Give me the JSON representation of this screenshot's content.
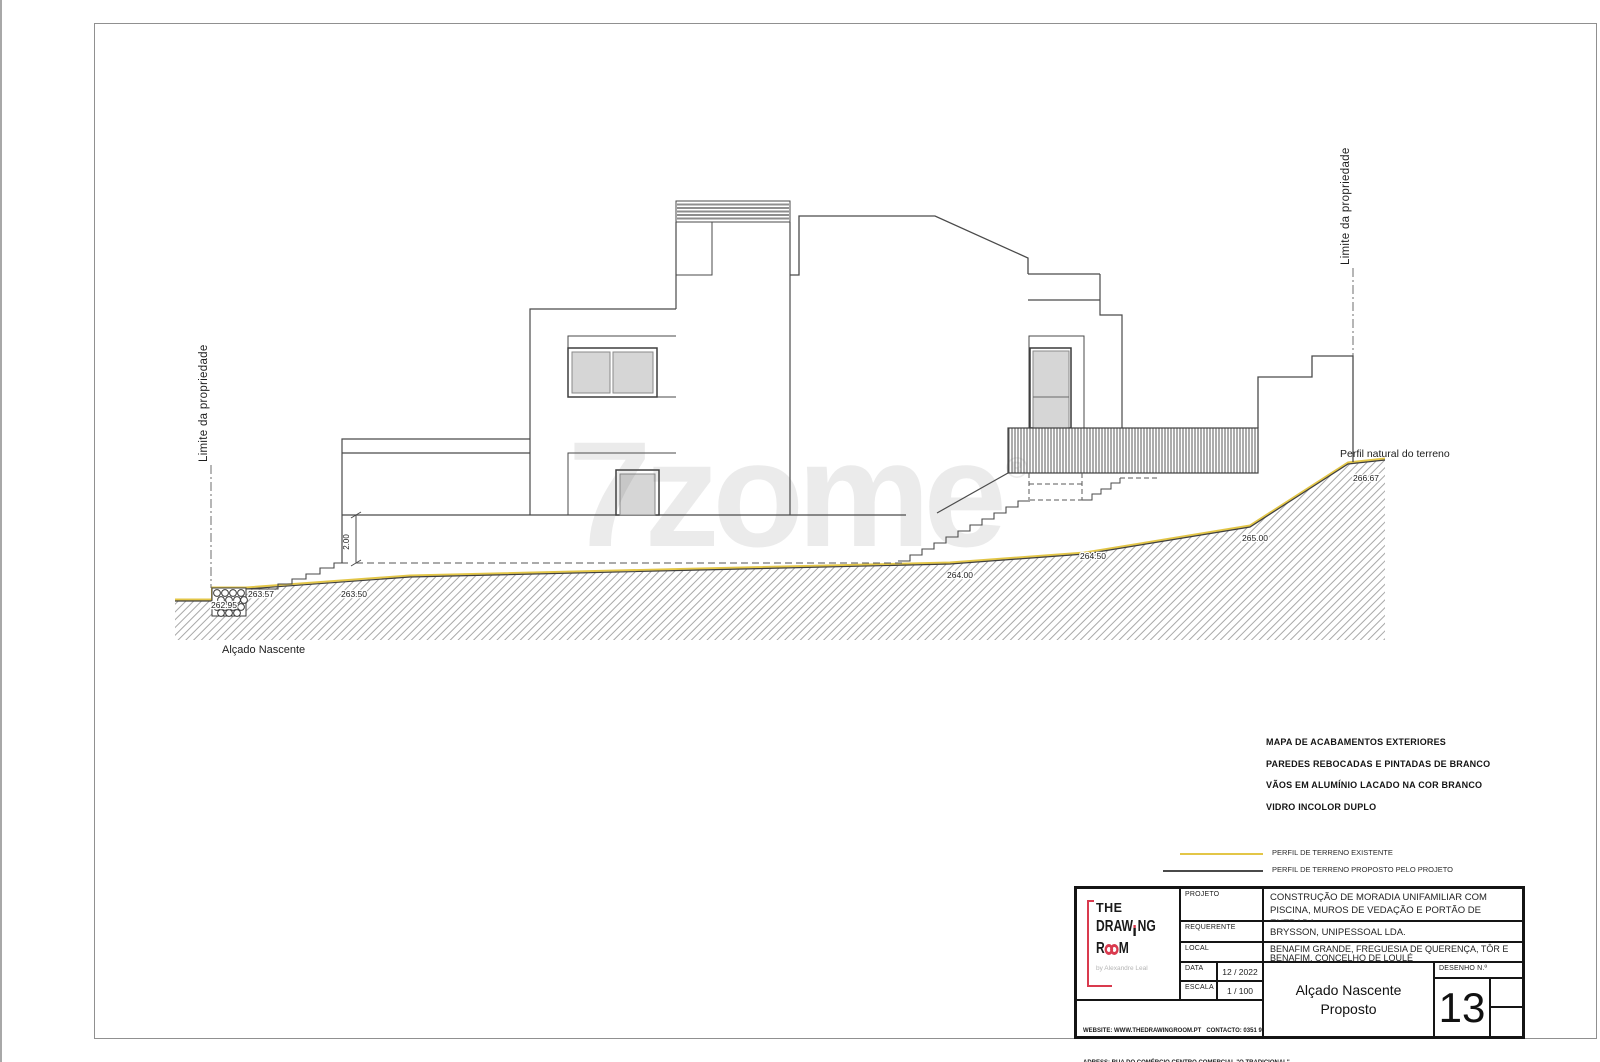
{
  "page": {
    "caption": "Alçado Nascente"
  },
  "watermark": {
    "text": "7zome",
    "reg": "®"
  },
  "drawing": {
    "property_limit_left": "Limite da propriedade",
    "property_limit_right": "Limite da propriedade",
    "natural_profile_label": "Perfil natural do terreno",
    "dimension": "2.00",
    "levels": {
      "l26295": "262.95",
      "l26357": "263.57",
      "l26350": "263.50",
      "l26400": "264.00",
      "l26450": "264.50",
      "l26500": "265.00",
      "l26667": "266.67"
    },
    "colors": {
      "existing_terrain": "#e3c647",
      "proposed_lines": "#4a4a4a",
      "glass": "#d6d6d6",
      "hatch": "#9f9f9f"
    }
  },
  "finishes": {
    "title": "MAPA DE ACABAMENTOS EXTERIORES",
    "items": [
      "PAREDES REBOCADAS E PINTADAS DE BRANCO",
      "VÃOS EM ALUMÍNIO LACADO NA COR BRANCO",
      "VIDRO INCOLOR DUPLO"
    ]
  },
  "legend": {
    "existing_label": "PERFIL DE TERRENO EXISTENTE",
    "proposed_label": "PERFIL DE TERRENO PROPOSTO PELO PROJETO",
    "existing_color": "#e3c647",
    "proposed_color": "#4a4a4a"
  },
  "title_block": {
    "logo": {
      "the": "THE",
      "draw": "DRAW",
      "ng": "NG",
      "room_r": "R",
      "room_m": "M",
      "tagline": "by Alexandre Leal",
      "accent_color": "#d93a4e"
    },
    "labels": {
      "projeto": "PROJETO",
      "requerente": "REQUERENTE",
      "local": "LOCAL",
      "data": "DATA",
      "escala": "ESCALA",
      "desenho": "DESENHO N.º"
    },
    "values": {
      "projeto": "CONSTRUÇÃO DE MORADIA UNIFAMILIAR COM PISCINA, MUROS DE VEDAÇÃO E PORTÃO DE ENTRADA.",
      "requerente": "BRYSSON, UNIPESSOAL LDA.",
      "local": "BENAFIM GRANDE, FREGUESIA DE QUERENÇA, TÔR E BENAFIM, CONCELHO DE LOULÉ",
      "data": "12 / 2022",
      "escala": "1 / 100",
      "titulo_line1": "Alçado Nascente",
      "titulo_line2": "Proposto",
      "numero": "13"
    },
    "footer": {
      "line1": "WEBSITE: WWW.THEDRAWINGROOM.PT   CONTACTO: 0351 912 296 042",
      "line2": "ADRESS: RUA DO COMÉRCIO CENTRO COMERCIAL \"O TRADICIONAL\"",
      "line3": "LOJA F, C  8135-128 ALMANCIL"
    }
  }
}
